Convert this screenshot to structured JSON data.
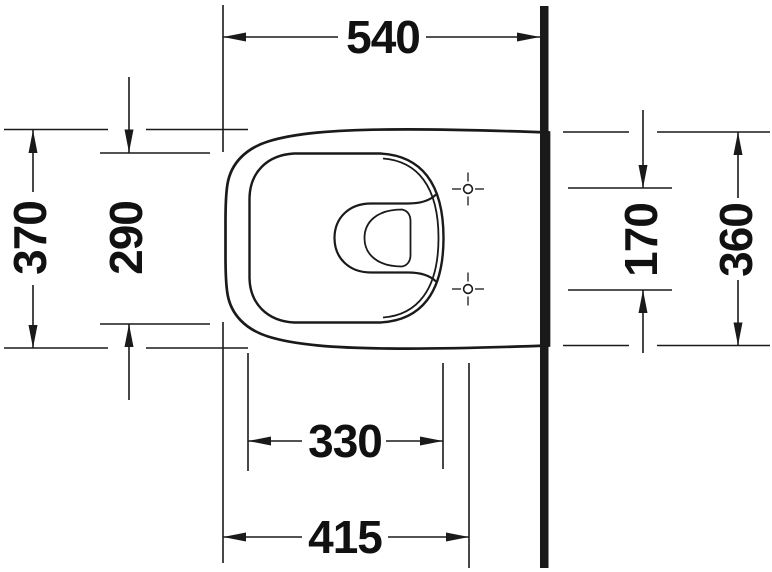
{
  "drawing": {
    "kind": "technical-dimension-drawing",
    "view": "plan view of wall-mounted toilet",
    "unit": "mm",
    "line_color": "#1a1a1a",
    "background_color": "#ffffff",
    "dimensions": {
      "overall_depth": "540",
      "overall_width": "370",
      "bowl_inner_width": "290",
      "seat_hole_spacing": "170",
      "width_at_wall": "360",
      "bowl_inner_length": "330",
      "front_to_seat_holes": "415"
    }
  }
}
